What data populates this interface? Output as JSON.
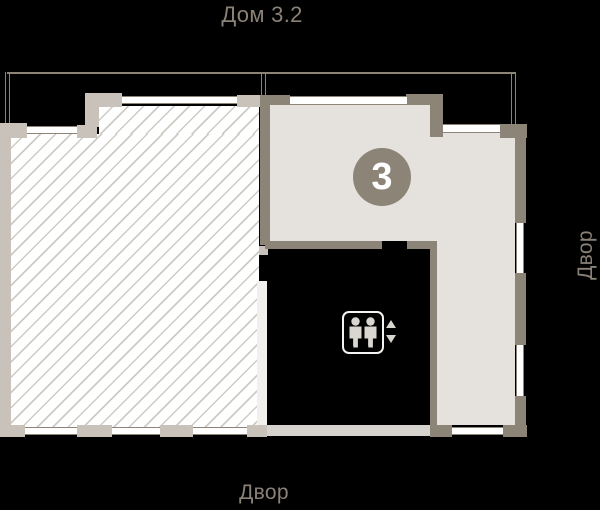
{
  "title": "Дом 3.2",
  "labels": {
    "bottom": "Двор",
    "right": "Двор"
  },
  "selected_apartment": {
    "badge_number": "3"
  },
  "icons": {
    "elevator": "elevator-icon",
    "arrow_up": "up-triangle",
    "arrow_down": "down-triangle"
  },
  "colors": {
    "background": "#000000",
    "selected_fill": "#e5e2dd",
    "wall_light": "#c8c2ba",
    "wall_dark": "#8d8478",
    "hatch_line": "#cecbc5",
    "label_text": "#8a8177",
    "badge_fill": "#8b8477",
    "badge_text": "#ffffff"
  }
}
